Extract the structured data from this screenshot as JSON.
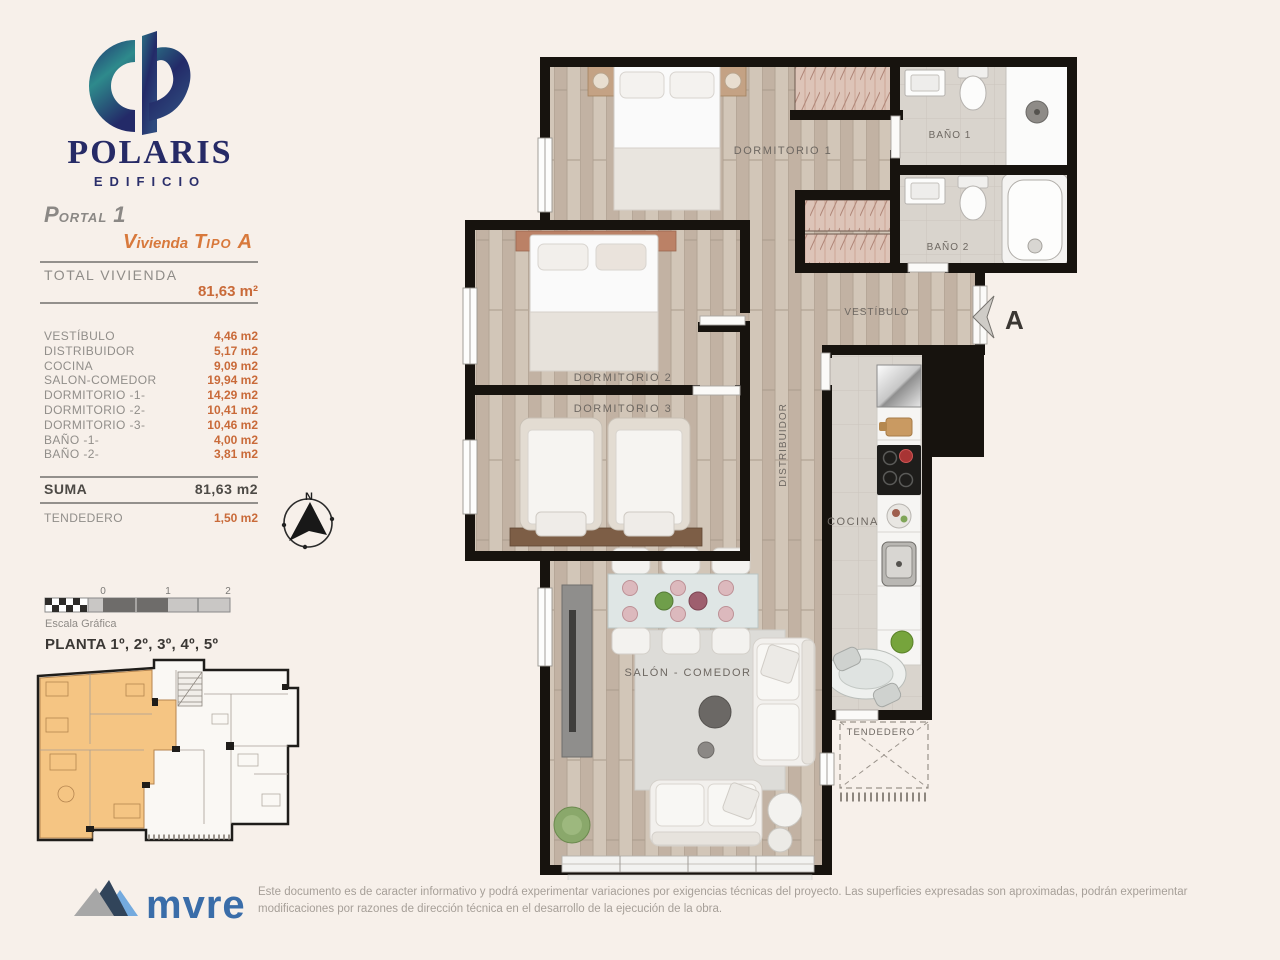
{
  "brand": {
    "name": "POLARIS",
    "subtitle": "EDIFICIO"
  },
  "header": {
    "portal_parts": [
      "P",
      "ORTAL",
      "1"
    ],
    "vivienda_parts": [
      "V",
      "ivienda",
      "T",
      "IPO",
      "A"
    ]
  },
  "summary": {
    "total_label": "TOTAL VIVIENDA",
    "total_value": "81,63 m²",
    "rooms": [
      {
        "label": "VESTÍBULO",
        "value": "4,46 m2"
      },
      {
        "label": "DISTRIBUIDOR",
        "value": "5,17 m2"
      },
      {
        "label": "COCINA",
        "value": "9,09 m2"
      },
      {
        "label": "SALON-COMEDOR",
        "value": "19,94 m2"
      },
      {
        "label": "DORMITORIO -1-",
        "value": "14,29 m2"
      },
      {
        "label": "DORMITORIO -2-",
        "value": "10,41 m2"
      },
      {
        "label": "DORMITORIO -3-",
        "value": "10,46 m2"
      },
      {
        "label": "BAÑO -1-",
        "value": "4,00 m2"
      },
      {
        "label": "BAÑO -2-",
        "value": "3,81 m2"
      }
    ],
    "suma_label": "SUMA",
    "suma_value": "81,63 m2",
    "tendedero_label": "TENDEDERO",
    "tendedero_value": "1,50 m2"
  },
  "compass": {
    "north": "N"
  },
  "scale_bar": {
    "ticks": [
      "0",
      "1",
      "2"
    ],
    "caption": "Escala Gráfica"
  },
  "key_plan": {
    "title": "PLANTA 1º, 2º, 3º, 4º, 5º",
    "highlight_color": "#f5c583"
  },
  "plan": {
    "labels": {
      "dormitorio1": "DORMITORIO 1",
      "dormitorio2": "DORMITORIO 2",
      "dormitorio3": "DORMITORIO 3",
      "bano1": "BAÑO 1",
      "bano2": "BAÑO 2",
      "vestibulo": "VESTÍBULO",
      "distribuidor": "DISTRIBUIDOR",
      "cocina": "COCINA",
      "salon": "SALÓN - COMEDOR",
      "tendedero": "TENDEDERO"
    },
    "entrance_marker": "A"
  },
  "footer": {
    "brand": "mvre",
    "disclaimer": "Este documento es de caracter informativo y podrá experimentar variaciones por exigencias técnicas del proyecto. Las superficies expresadas son aproximadas, podrán experimentar modificaciones por razones de dirección técnica en el desarrollo de la ejecución de la obra."
  },
  "colors": {
    "accent_orange": "#c96a39",
    "navy": "#262a66",
    "teal": "#2e8a8c",
    "wall": "#17130e",
    "wood_floor": "#cbbeb0",
    "tile_floor": "#d9d4cd",
    "background": "#f7f0ea"
  }
}
